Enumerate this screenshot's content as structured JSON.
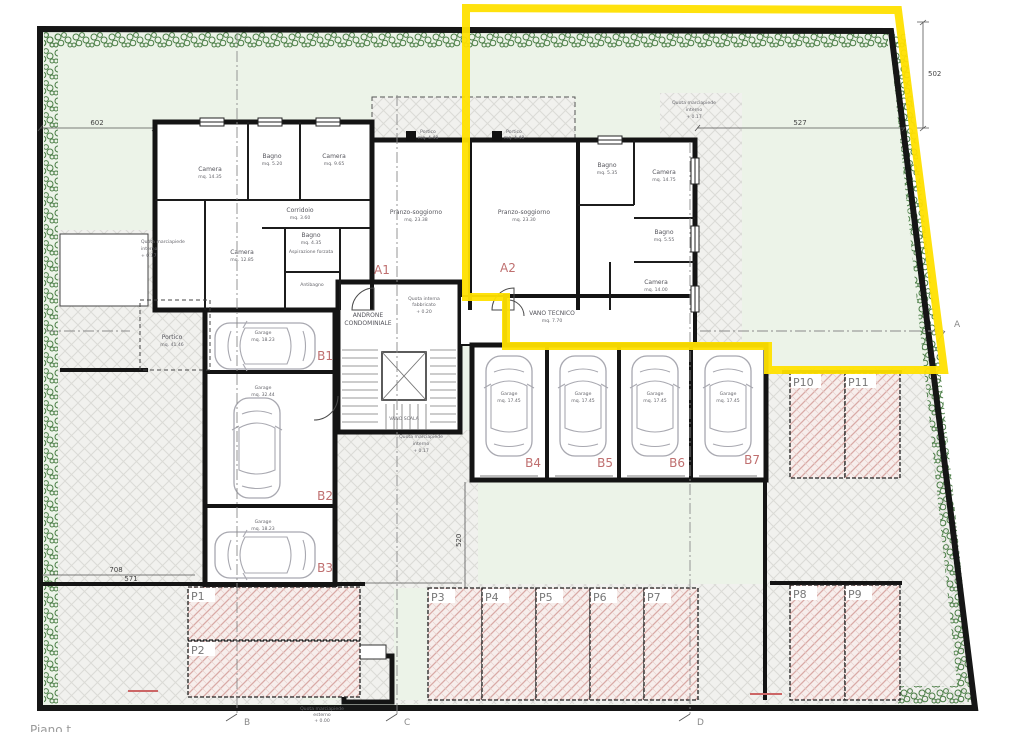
{
  "plan": {
    "sheet_title_fragment": "Piano t",
    "apartments": {
      "a1": "A1",
      "a2": "A2"
    },
    "rooms": {
      "a1_camera_nw": {
        "name": "Camera",
        "area": "mq. 14.35"
      },
      "a1_bagno_n": {
        "name": "Bagno",
        "area": "mq. 5.20"
      },
      "a1_camera_n": {
        "name": "Camera",
        "area": "mq. 9.65"
      },
      "a1_corridoio": {
        "name": "Corridoio",
        "area": "mq. 3.60"
      },
      "a1_camera_w": {
        "name": "Camera",
        "area": "mq. 12.85"
      },
      "a1_bagno_s": {
        "name": "Bagno",
        "area": "mq. 4.35"
      },
      "a1_antibagno": {
        "name": "Antibagno",
        "area": ""
      },
      "a1_pranzo": {
        "name": "Pranzo-soggiorno",
        "area": "mq. 23.38"
      },
      "a1_portico": {
        "name": "Portico",
        "area": "mq. 4.48"
      },
      "a2_portico": {
        "name": "Portico",
        "area": "mq. 4.48"
      },
      "a2_pranzo": {
        "name": "Pranzo-soggiorno",
        "area": "mq. 23.30"
      },
      "a2_bagno_n": {
        "name": "Bagno",
        "area": "mq. 5.35"
      },
      "a2_camera_ne": {
        "name": "Camera",
        "area": "mq. 14.75"
      },
      "a2_bagno_e": {
        "name": "Bagno",
        "area": "mq. 5.55"
      },
      "a2_camera_se": {
        "name": "Camera",
        "area": "mq. 14.00"
      },
      "portico_ovest": {
        "name": "Portico",
        "area": "mq. 41.46"
      },
      "androne": {
        "line1": "ANDRONE",
        "line2": "CONDOMINIALE"
      },
      "vano_scala": {
        "name": "VANO SCALA"
      },
      "vano_tecnico": {
        "name": "VANO TECNICO",
        "area": "mq. 7.70"
      }
    },
    "bath_note": "Aspirazione forzata",
    "garages": {
      "b1": {
        "tag": "B1",
        "name": "Garage",
        "area": "mq. 18.23"
      },
      "b2": {
        "tag": "B2",
        "name": "Garage",
        "area": "mq. 32.44"
      },
      "b3": {
        "tag": "B3",
        "name": "Garage",
        "area": "mq. 18.23"
      },
      "b4": {
        "tag": "B4",
        "name": "Garage",
        "area": "mq. 17.45"
      },
      "b5": {
        "tag": "B5",
        "name": "Garage",
        "area": "mq. 17.45"
      },
      "b6": {
        "tag": "B6",
        "name": "Garage",
        "area": "mq. 17.45"
      },
      "b7": {
        "tag": "B7",
        "name": "Garage",
        "area": "mq. 17.45"
      }
    },
    "parking": {
      "p1": "P1",
      "p2": "P2",
      "p3": "P3",
      "p4": "P4",
      "p5": "P5",
      "p6": "P6",
      "p7": "P7",
      "p8": "P8",
      "p9": "P9",
      "p10": "P10",
      "p11": "P11"
    },
    "levels": {
      "interna": [
        "Quota interna",
        "fabbricato",
        "+ 0.20"
      ],
      "marciapiede_interno": [
        "Quota marciapiede",
        "interno",
        "+ 0.17"
      ],
      "marciapiede_esterno": [
        "Quota marciapiede",
        "esterno",
        "+ 0.00"
      ]
    },
    "dimensions": {
      "top_left": "602",
      "top_right": "527",
      "right": "502",
      "court": "520",
      "bottom_a": "708",
      "bottom_b": "571"
    },
    "section_markers": {
      "a": "A",
      "b": "B",
      "c": "C",
      "d": "D"
    },
    "colors": {
      "boundary_highlight": "#ffe000",
      "label_accent": "#bf6f6f",
      "hedge": "#4a7d45",
      "lawn": "#ecf3e8",
      "parking_hatch": "#d9a9a5"
    }
  }
}
